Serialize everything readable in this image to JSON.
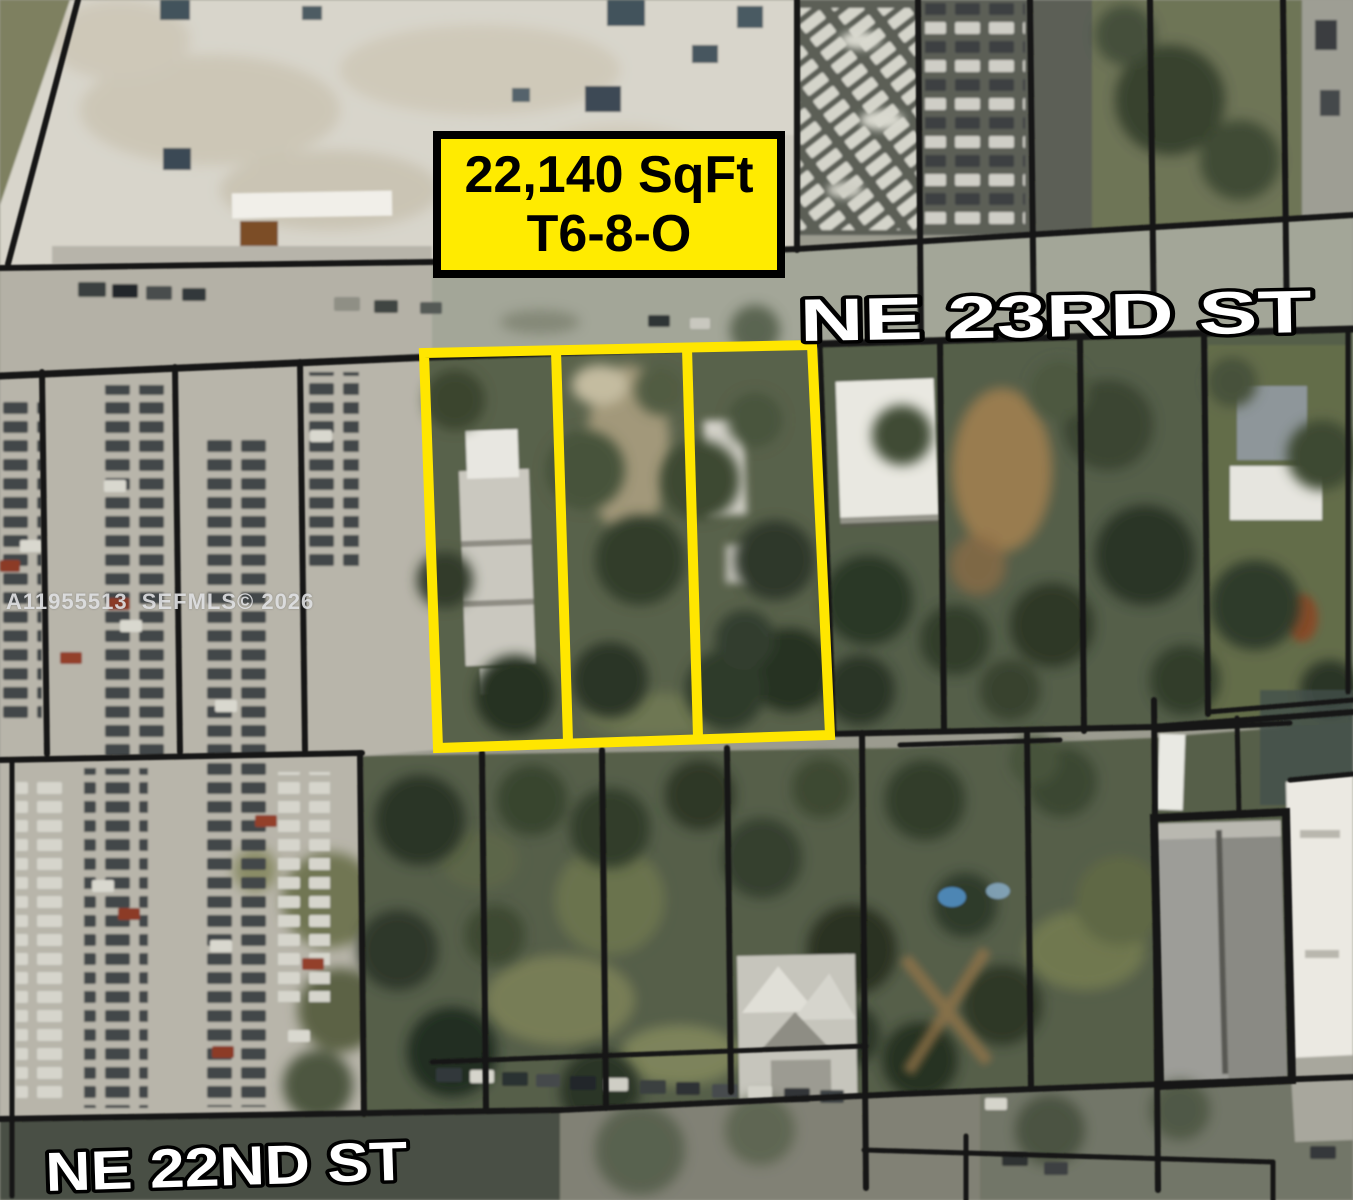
{
  "map_annotations": {
    "area_label": {
      "line1": "22,140 SqFt",
      "line2": "T6-8-O"
    },
    "street_labels": {
      "top": "NE 23RD ST",
      "bottom": "NE 22ND ST"
    },
    "watermark": "A11955513  SEFMLS© 2026",
    "colors": {
      "parcel_highlight": "#FFE600",
      "label_background": "#FFEB00",
      "label_border": "#000000",
      "boundary_lines": "#141412",
      "street_text": "#FFFFFF"
    }
  }
}
